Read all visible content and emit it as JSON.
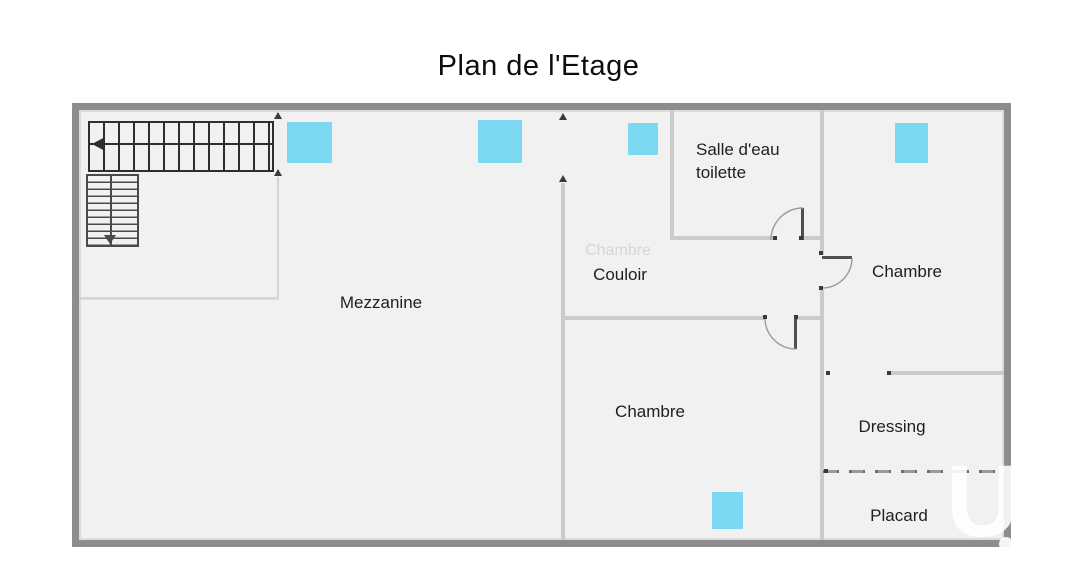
{
  "title": "Plan de l'Etage",
  "plan": {
    "rooms": {
      "mezzanine": "Mezzanine",
      "couloir": "Couloir",
      "salle_deau_line1": "Salle d'eau",
      "salle_deau_line2": "toilette",
      "chambre_right": "Chambre",
      "chambre_bottom": "Chambre",
      "dressing": "Dressing",
      "placard": "Placard",
      "ghost_label": "Chambre"
    },
    "colors": {
      "skylight": "#7cd7f0",
      "outer_wall": "#8d8d8d",
      "inner_wall": "#c9cbcc",
      "floor": "#f1f1f1",
      "stairs": "#2e2e2e"
    }
  },
  "watermark": {
    "letter": "U"
  }
}
